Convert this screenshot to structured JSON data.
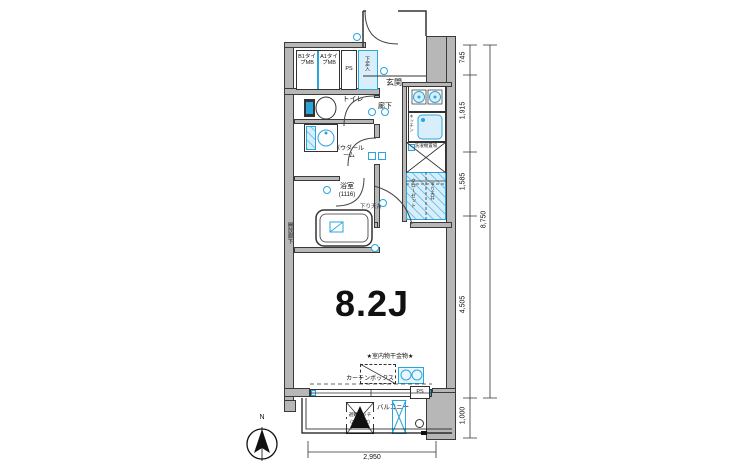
{
  "plan": {
    "rooms": {
      "entrance": "玄関",
      "toilet": "トイレ",
      "hallway": "廊下",
      "powder_room": "パウダールーム",
      "bathroom": "浴室",
      "bathroom_size": "(1116)",
      "main_room": "8.2J",
      "balcony": "バルコニー",
      "closet": "クローゼット",
      "kitchen": "キッチン",
      "laundry": "洗濯機置場",
      "shoe_cabinet": "下足入",
      "open_corridor": "開放廊下"
    },
    "labels": {
      "mb_b1": "B1タイプMB",
      "mb_a1": "A1タイプMB",
      "ps_top": "PS",
      "ps_bottom": "PS",
      "lowered_ceiling_hall": "下り天井",
      "lowered_ceiling_closet": "下り天井",
      "indoor_drying": "★室内物干金物★",
      "curtain_box": "カーテンボックス",
      "escape_hatch": "避難ハッチ",
      "escape_hatch_floors": "(3.4.5.6F)",
      "compass_north": "N"
    },
    "dimensions": {
      "right_segments": [
        "745",
        "1,915",
        "1,585",
        "4,505",
        "1,000"
      ],
      "right_total": "8,750",
      "bottom_width": "2,950"
    },
    "colors": {
      "wall_fill": "#b7b7b7",
      "fixture_blue": "#2aa5dc",
      "fixture_fill": "#d9eefb",
      "line": "#1a1a1a"
    }
  }
}
